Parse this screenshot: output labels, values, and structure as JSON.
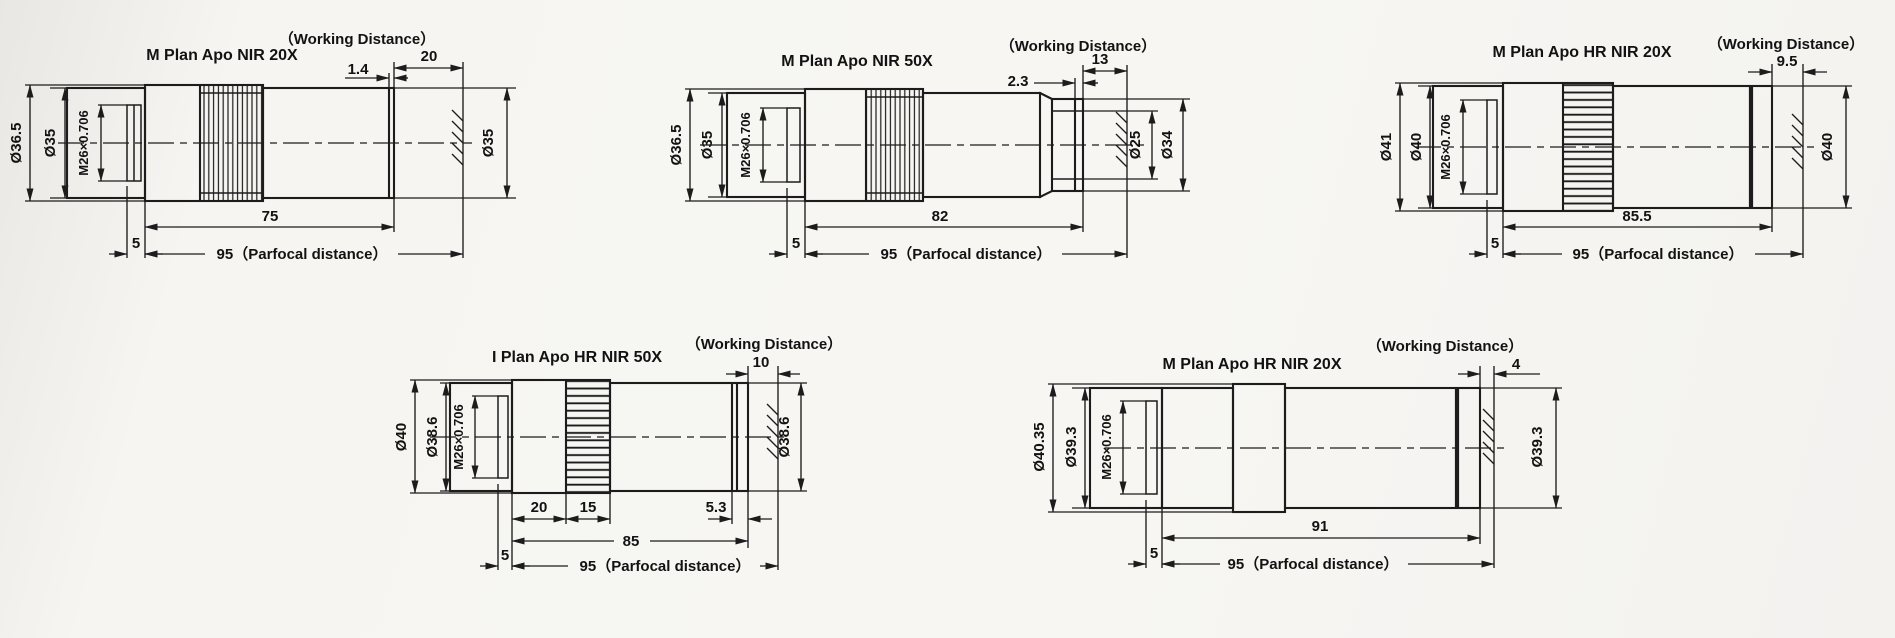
{
  "labels": {
    "working_distance": "（Working Distance）",
    "parfocal": "95（Parfocal distance）"
  },
  "thread_spec": "M26×0.706",
  "objectives": [
    {
      "title": "M Plan Apo NIR 20X",
      "working_distance": "20",
      "tip_dim": "1.4",
      "thread": "M26×0.706",
      "dia_outer": "Ø36.5",
      "dia_mount": "Ø35",
      "dia_front": "Ø35",
      "body_length": "75",
      "thread_length": "5"
    },
    {
      "title": "M Plan Apo NIR 50X",
      "working_distance": "13",
      "tip_dim": "2.3",
      "thread": "M26×0.706",
      "dia_outer": "Ø36.5",
      "dia_mount": "Ø35",
      "dia_front_inner": "Ø25",
      "dia_front_outer": "Ø34",
      "body_length": "82",
      "thread_length": "5"
    },
    {
      "title": "M Plan Apo HR NIR 20X",
      "working_distance": "9.5",
      "thread": "M26×0.706",
      "dia_outer": "Ø41",
      "dia_mount": "Ø40",
      "dia_front": "Ø40",
      "body_length": "85.5",
      "thread_length": "5"
    },
    {
      "title": "I Plan Apo HR NIR 50X",
      "working_distance": "10",
      "tip_dim": "5.3",
      "seg_a": "20",
      "seg_b": "15",
      "thread": "M26×0.706",
      "dia_outer": "Ø40",
      "dia_mount": "Ø38.6",
      "dia_front": "Ø38.6",
      "body_length": "85",
      "thread_length": "5"
    },
    {
      "title": "M Plan Apo HR NIR 20X",
      "working_distance": "4",
      "thread": "M26×0.706",
      "dia_outer": "Ø40.35",
      "dia_mount": "Ø39.3",
      "dia_front": "Ø39.3",
      "body_length": "91",
      "thread_length": "5"
    }
  ]
}
